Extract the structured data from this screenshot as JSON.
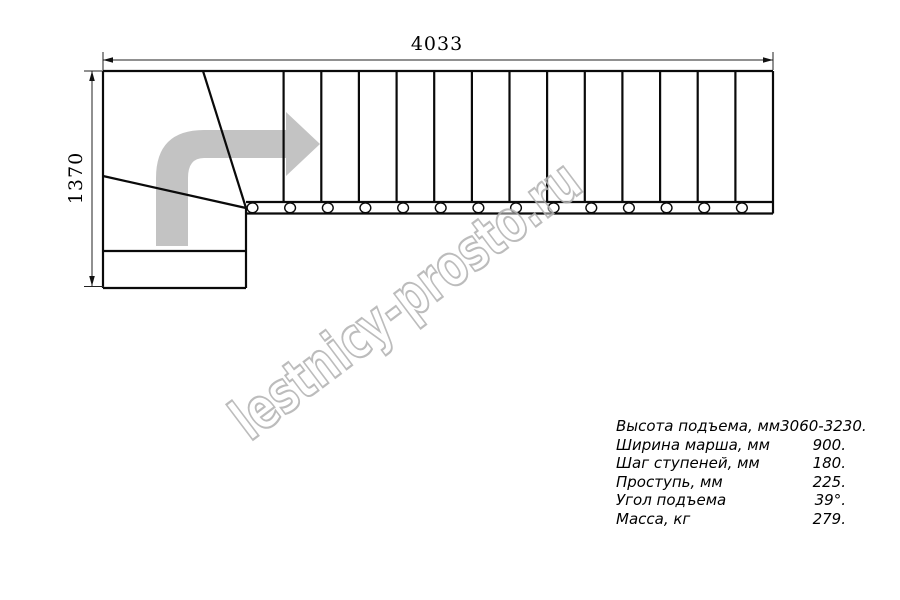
{
  "dimensions": {
    "width_label": "4033",
    "height_label": "1370"
  },
  "drawing": {
    "tread_count": 14,
    "straight_tread_lines": 13,
    "bolt_circle_count": 14
  },
  "watermark": {
    "text": "lestnicy-prosto.ru",
    "color": "#b0b0b0"
  },
  "arrow_color": "#c3c3c3",
  "line_color": "#0a0a0a",
  "specs": {
    "rows": [
      {
        "label": "Высота подъема, мм",
        "value": "3060-3230."
      },
      {
        "label": "Ширина марша, мм",
        "value": "900."
      },
      {
        "label": "Шаг ступеней, мм",
        "value": "180."
      },
      {
        "label": "Проступь, мм",
        "value": "225."
      },
      {
        "label": "Угол подъема",
        "value": "39°."
      },
      {
        "label": "Масса, кг",
        "value": "279."
      }
    ]
  }
}
